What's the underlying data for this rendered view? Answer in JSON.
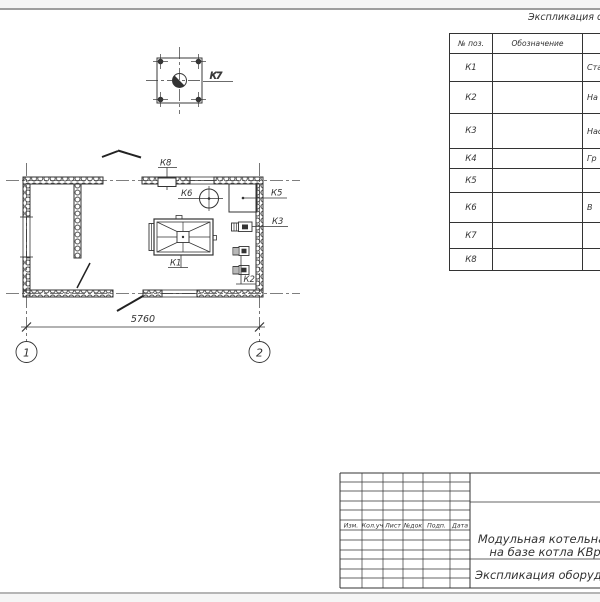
{
  "equipment_table": {
    "title": "Экспликация оборудования",
    "col_headers": {
      "pos": "№ поз.",
      "designation": "Обозначение",
      "name": ""
    },
    "rows": [
      {
        "pos": "К1",
        "designation": "",
        "name": "Стал"
      },
      {
        "pos": "К2",
        "designation": "",
        "name": "На"
      },
      {
        "pos": "К3",
        "designation": "",
        "name": "Насос"
      },
      {
        "pos": "К4",
        "designation": "",
        "name": "Гр"
      },
      {
        "pos": "К5",
        "designation": "",
        "name": ""
      },
      {
        "pos": "К6",
        "designation": "",
        "name": "В"
      },
      {
        "pos": "К7",
        "designation": "",
        "name": ""
      },
      {
        "pos": "К8",
        "designation": "",
        "name": ""
      }
    ]
  },
  "plan": {
    "equipment_labels": {
      "k1": "К1",
      "k2": "К2",
      "k3": "К3",
      "k5": "К5",
      "k6": "К6",
      "k8": "К8"
    },
    "detail_label": "К7",
    "dimension_width": "5760",
    "axis_left": "1",
    "axis_right": "2"
  },
  "title_block": {
    "col_headers": [
      "Изм.",
      "Кол.уч",
      "Лист",
      "№док",
      "Подп.",
      "Дата"
    ],
    "doc_title_line1": "Модульная котельная",
    "doc_title_line2": "на базе котла КВр",
    "sheet_name": "Экспликация оборудования"
  },
  "colors": {
    "line": "#333333",
    "page_edge": "#9e9e9e"
  }
}
